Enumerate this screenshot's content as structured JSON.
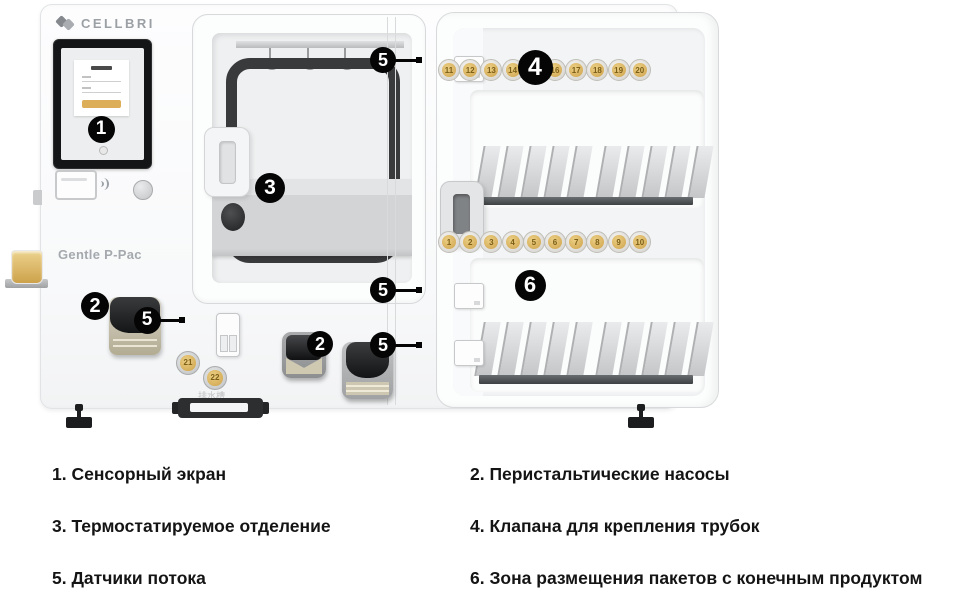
{
  "machine": {
    "brand": "CELLBRI",
    "model_label": "Gentle P-Pac",
    "drain_label": "排水槽",
    "accent_gold": "#d2a855",
    "valves": {
      "top_row": [
        "11",
        "12",
        "13",
        "14",
        "15",
        "16",
        "17",
        "18",
        "19",
        "20"
      ],
      "middle_row": [
        "1",
        "2",
        "3",
        "4",
        "5",
        "6",
        "7",
        "8",
        "9",
        "10"
      ],
      "front": [
        "21",
        "22"
      ]
    }
  },
  "callouts": [
    {
      "n": "1",
      "x": 101,
      "y": 129,
      "d": 27
    },
    {
      "n": "2",
      "x": 95,
      "y": 306,
      "d": 28
    },
    {
      "n": "2",
      "x": 320,
      "y": 344,
      "d": 26
    },
    {
      "n": "3",
      "x": 270,
      "y": 188,
      "d": 30
    },
    {
      "n": "4",
      "x": 535,
      "y": 67,
      "d": 35
    },
    {
      "n": "5",
      "x": 147,
      "y": 320,
      "d": 27,
      "leader": 16
    },
    {
      "n": "5",
      "x": 383,
      "y": 60,
      "d": 26,
      "leader": 18
    },
    {
      "n": "5",
      "x": 383,
      "y": 290,
      "d": 26,
      "leader": 18
    },
    {
      "n": "5",
      "x": 383,
      "y": 345,
      "d": 26,
      "leader": 18
    },
    {
      "n": "6",
      "x": 530,
      "y": 285,
      "d": 31
    }
  ],
  "legend": {
    "left_column": [
      "1. Сенсорный экран",
      "3. Термостатируемое отделение",
      "5. Датчики потока"
    ],
    "right_column": [
      "2. Перистальтические насосы",
      "4. Клапана для крепления трубок",
      "6. Зона размещения пакетов с конечным продуктом"
    ]
  }
}
